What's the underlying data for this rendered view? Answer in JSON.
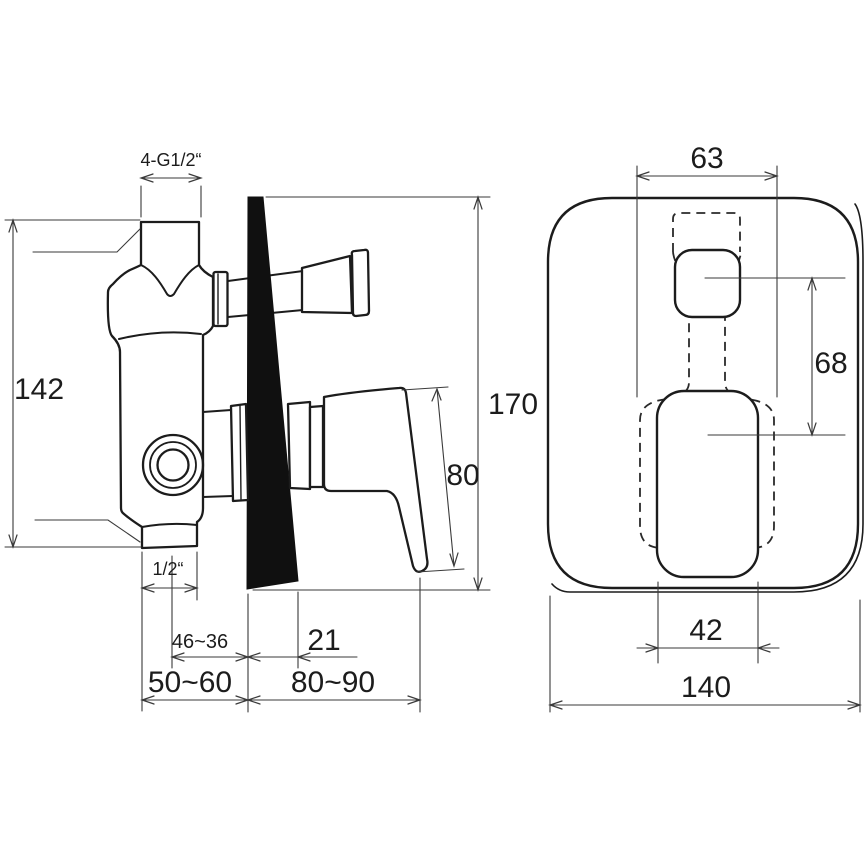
{
  "drawing": {
    "kind": "technical-dimension-drawing",
    "subject": "concealed-shower-mixer-valve",
    "colors": {
      "line": "#1c1c1c",
      "wall_section_fill": "#101010",
      "background": "#ffffff"
    },
    "views": {
      "left": "side-section-through-wall",
      "right": "front-trim-plate"
    },
    "dimensions": {
      "thread_connections": "4-G1/2“",
      "inlet_height": "142",
      "total_height": "170",
      "lever_length": "80",
      "bottom_outlet": "1/2“",
      "mounting_depth_range": "46~36",
      "wall_offset": "21",
      "install_depth_left": "50~60",
      "install_depth_right": "80~90",
      "trim_hole_width": "63",
      "handle_center_distance": "68",
      "handle_width": "42",
      "trim_plate_width": "140"
    }
  }
}
